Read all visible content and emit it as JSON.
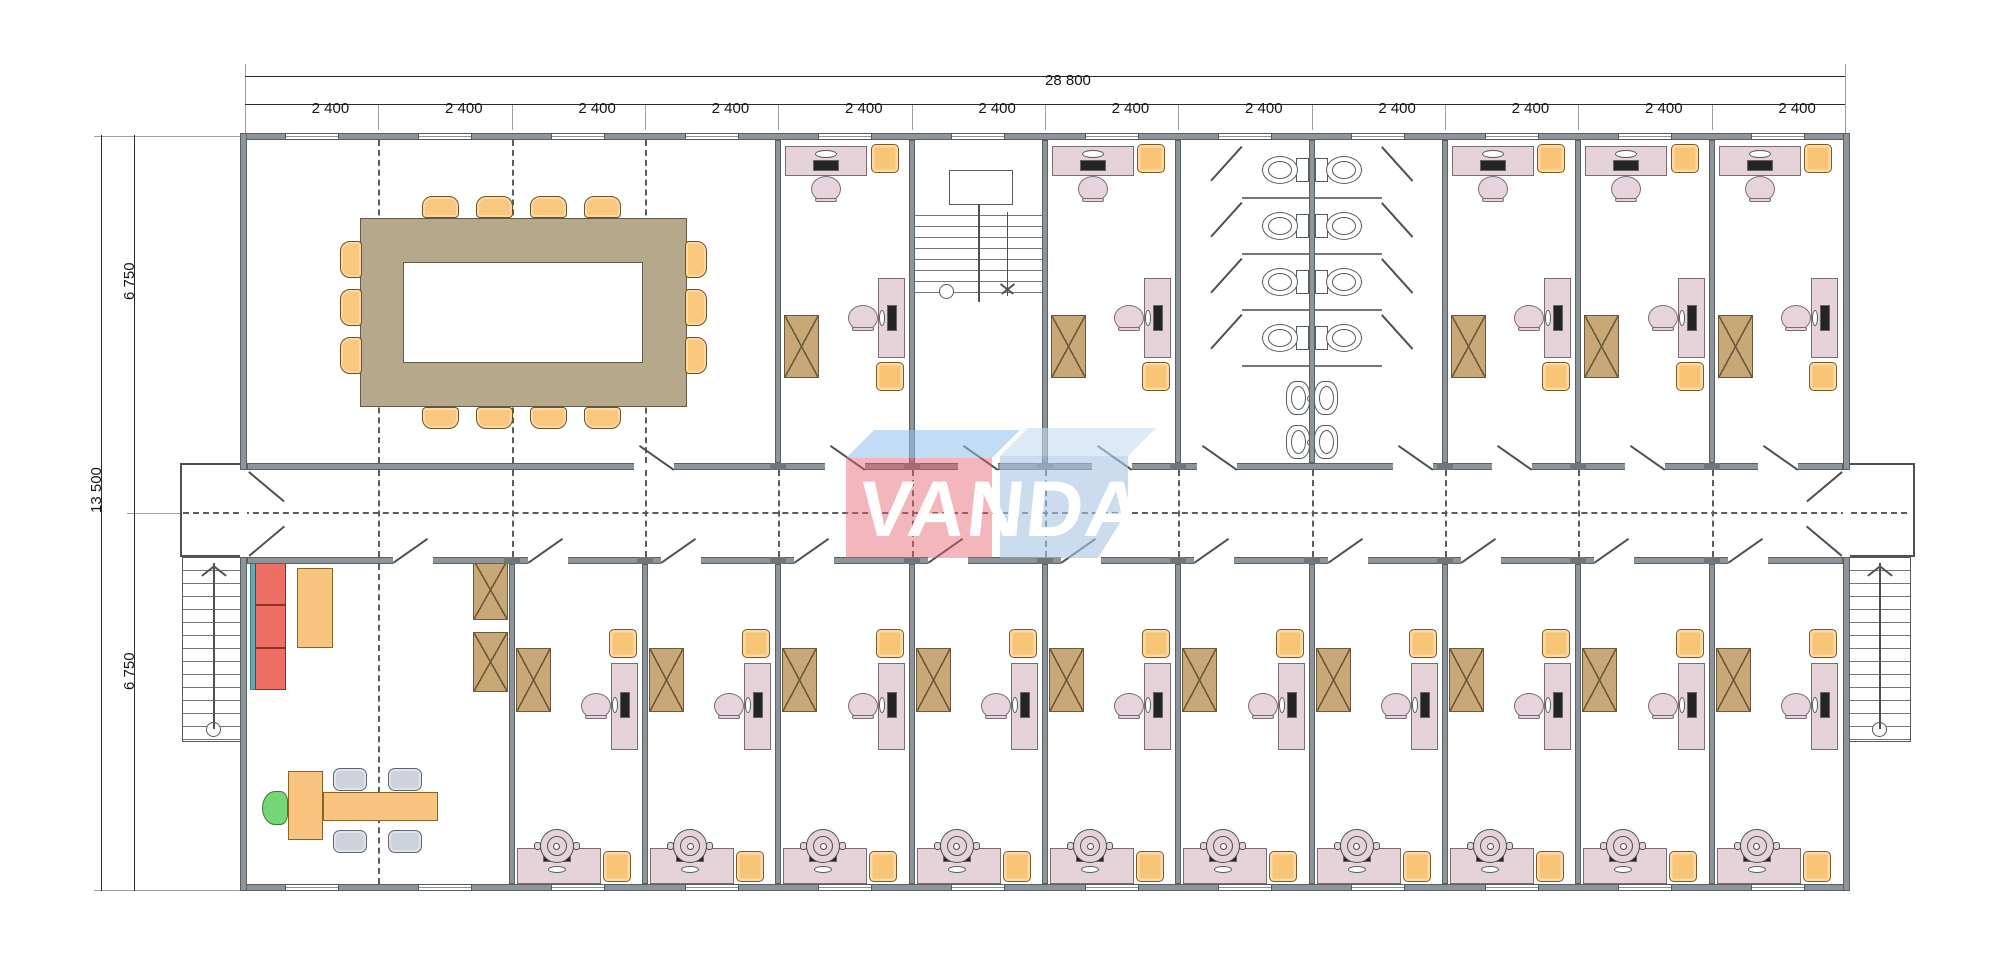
{
  "drawing": {
    "type": "modular-building-floor-plan",
    "units": "millimeters"
  },
  "watermark": {
    "text": "VANDA",
    "left_cube_front": "rgba(231,93,109,0.45)",
    "left_cube_top": "rgba(142,193,237,0.55)",
    "right_cube_front": "rgba(168,197,226,0.60)",
    "right_cube_top": "rgba(196,219,242,0.60)",
    "text_color": "#ffffff"
  },
  "dimensions": {
    "total_width_label": "28 800",
    "module_width_label": "2 400",
    "module_count": 12,
    "total_height_label": "13 500",
    "half_height_label": "6 750",
    "half_count": 2
  },
  "rooms": {
    "top": [
      {
        "id": "meeting-room",
        "modules": 4,
        "furniture": "conference",
        "seats": 14
      },
      {
        "id": "office-top-1",
        "modules": 1,
        "furniture": "office-top"
      },
      {
        "id": "stairwell",
        "modules": 1,
        "furniture": "stairs-internal"
      },
      {
        "id": "office-top-2",
        "modules": 1,
        "furniture": "office-top"
      },
      {
        "id": "washrooms",
        "modules": 2,
        "furniture": "toilets",
        "toilet_stalls": 8,
        "sinks": 4
      },
      {
        "id": "office-top-3",
        "modules": 1,
        "furniture": "office-top"
      },
      {
        "id": "office-top-4",
        "modules": 1,
        "furniture": "office-top"
      },
      {
        "id": "office-top-5",
        "modules": 1,
        "furniture": "office-top"
      }
    ],
    "bottom": [
      {
        "id": "executive-office",
        "modules": 2,
        "furniture": "executive"
      },
      {
        "id": "office-bottom-1",
        "modules": 1,
        "furniture": "office-bottom"
      },
      {
        "id": "office-bottom-2",
        "modules": 1,
        "furniture": "office-bottom"
      },
      {
        "id": "office-bottom-3",
        "modules": 1,
        "furniture": "office-bottom"
      },
      {
        "id": "office-bottom-4",
        "modules": 1,
        "furniture": "office-bottom"
      },
      {
        "id": "office-bottom-5",
        "modules": 1,
        "furniture": "office-bottom"
      },
      {
        "id": "office-bottom-6",
        "modules": 1,
        "furniture": "office-bottom"
      },
      {
        "id": "office-bottom-7",
        "modules": 1,
        "furniture": "office-bottom"
      },
      {
        "id": "office-bottom-8",
        "modules": 1,
        "furniture": "office-bottom"
      },
      {
        "id": "office-bottom-9",
        "modules": 1,
        "furniture": "office-bottom"
      },
      {
        "id": "office-bottom-10",
        "modules": 1,
        "furniture": "office-bottom"
      }
    ]
  },
  "features": {
    "central_corridor": true,
    "entrance_vestibules": 2,
    "external_stairs": 2,
    "internal_staircase": 1,
    "windows_per_long_wall": 12
  },
  "colors": {
    "wall": "#8d959a",
    "desk": "#e5d3d9",
    "desk_edge": "#7c6b73",
    "monitor": "#242424",
    "chair_pink": "#e7d3db",
    "chair_yellow": "#f8c577",
    "chair_yellow_edge": "#7c5c20",
    "cabinet": "#c9a877",
    "cabinet_edge": "#6b5939",
    "conference_table": "#b5a88b",
    "conference_table_edge": "#625a49",
    "conference_chair": "#f9c87e",
    "sofa_red": "#ee6f63",
    "sofa_edge": "#8e2f26",
    "sofa_back_teal": "#64aab2",
    "exec_orange": "#f8c480",
    "exec_orange_edge": "#8a6426",
    "chair_gray": "#ccd3db",
    "chair_gray_edge": "#5d6570",
    "chair_green": "#74d675",
    "chair_green_edge": "#2f7d36"
  }
}
